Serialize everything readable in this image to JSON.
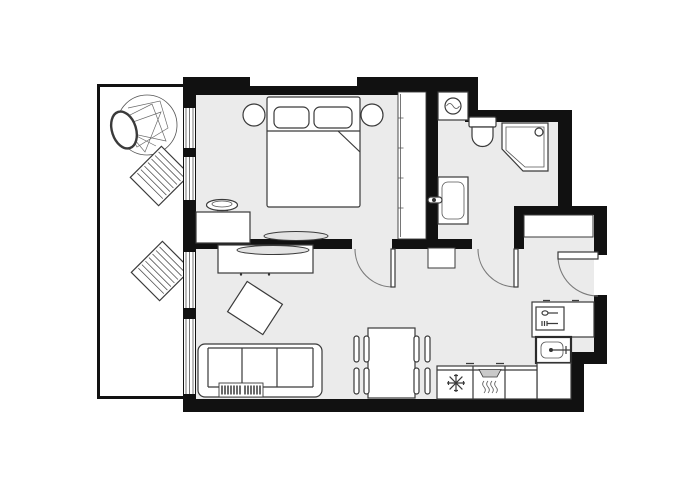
{
  "document": {
    "kind": "apartment-floor-plan",
    "visible_text": "none"
  },
  "palette": {
    "wall_color": "#111111",
    "floor_color": "#ebebeb",
    "outline_color": "#3a3a3a",
    "furniture_fill": "#ffffff",
    "tv_fill": "#e3e3e3",
    "hood_fill": "#c9c9c9",
    "background": "#ffffff"
  },
  "rooms": [
    {
      "id": "balcony",
      "name": "Balcony",
      "position": "left strip",
      "floor": "white, thin balustrade outline"
    },
    {
      "id": "bedroom",
      "name": "Bedroom",
      "position": "top-center",
      "floor": "light gray"
    },
    {
      "id": "bathroom",
      "name": "Bathroom",
      "position": "top-right",
      "floor": "light gray"
    },
    {
      "id": "hallway",
      "name": "Entrance hall",
      "position": "right-center",
      "floor": "light gray"
    },
    {
      "id": "living-kitchen",
      "name": "Living room with open kitchen",
      "position": "bottom",
      "floor": "light gray"
    }
  ],
  "furniture": {
    "balcony": [
      "potted-tree",
      "sun-lounger",
      "sun-lounger"
    ],
    "bedroom": [
      "double-bed",
      "pillow x2",
      "blanket-fold",
      "bedside-lamp x2",
      "dresser",
      "plant-decor",
      "wall-tv",
      "built-in-wardrobe"
    ],
    "bathroom": [
      "washing-machine",
      "toilet",
      "corner-shower",
      "washbasin"
    ],
    "hallway": [
      "hall-cabinet",
      "shoe-cabinet"
    ],
    "living": [
      "tv-console",
      "tv",
      "coffee-table-rotated",
      "sofa-3-seat",
      "radiator",
      "dining-table",
      "dining-chair x4"
    ],
    "kitchen": [
      "counter-L",
      "dishwasher-unit",
      "kitchen-sink",
      "fridge-freezer",
      "stove-with-hood"
    ]
  },
  "doors": [
    {
      "id": "bedroom-door",
      "type": "swing",
      "between": [
        "bedroom",
        "living-kitchen"
      ]
    },
    {
      "id": "bathroom-door",
      "type": "swing",
      "between": [
        "bathroom",
        "hallway"
      ]
    },
    {
      "id": "entrance-door",
      "type": "swing",
      "between": [
        "outside",
        "hallway"
      ],
      "wall": "right"
    }
  ],
  "windows": [
    {
      "id": "bedroom-window",
      "wall": "left",
      "segments": 2
    },
    {
      "id": "living-window",
      "wall": "left",
      "segments": 2
    }
  ],
  "counts": {
    "dining_chairs": 4,
    "sofa_seats": 3,
    "sun_loungers": 2,
    "tvs": 2
  }
}
